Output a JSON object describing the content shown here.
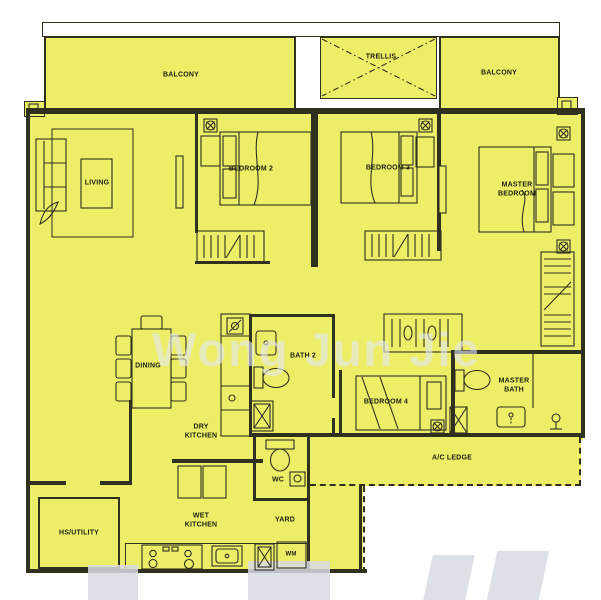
{
  "rooms": {
    "balcony_left": {
      "label": "BALCONY"
    },
    "trellis": {
      "label": "TRELLIS"
    },
    "balcony_right": {
      "label": "BALCONY"
    },
    "living": {
      "label": "LIVING"
    },
    "bedroom2": {
      "label": "BEDROOM 2"
    },
    "bedroom3": {
      "label": "BEDROOM 3"
    },
    "master_bedroom": {
      "label": "MASTER BEDROOM"
    },
    "dining": {
      "label": "DINING"
    },
    "bath2": {
      "label": "BATH 2"
    },
    "bedroom4": {
      "label": "BEDROOM 4"
    },
    "master_bath": {
      "label": "MASTER BATH"
    },
    "dry_kitchen": {
      "label": "DRY KITCHEN"
    },
    "wc": {
      "label": "WC"
    },
    "ac_ledge": {
      "label": "A/C LEDGE"
    },
    "hs_utility": {
      "label": "HS/UTILITY"
    },
    "wet_kitchen": {
      "label": "WET KITCHEN"
    },
    "yard": {
      "label": "YARD"
    },
    "wm": {
      "label": "WM"
    }
  },
  "watermark": {
    "text": "Wong Jun Jie"
  },
  "icons": {
    "fan_coil_unit": "square-with-circled-cross",
    "shower": "x-box",
    "trellis_mark": "dash-dot-x-cross"
  },
  "colors": {
    "plan_fill": "#edee68",
    "wall_line": "#30301f",
    "label_text": "#1e1e12",
    "watermark_text": "#e4e7ef",
    "watermark_fragment": "#d8dbe4",
    "background": "#ffffff"
  }
}
